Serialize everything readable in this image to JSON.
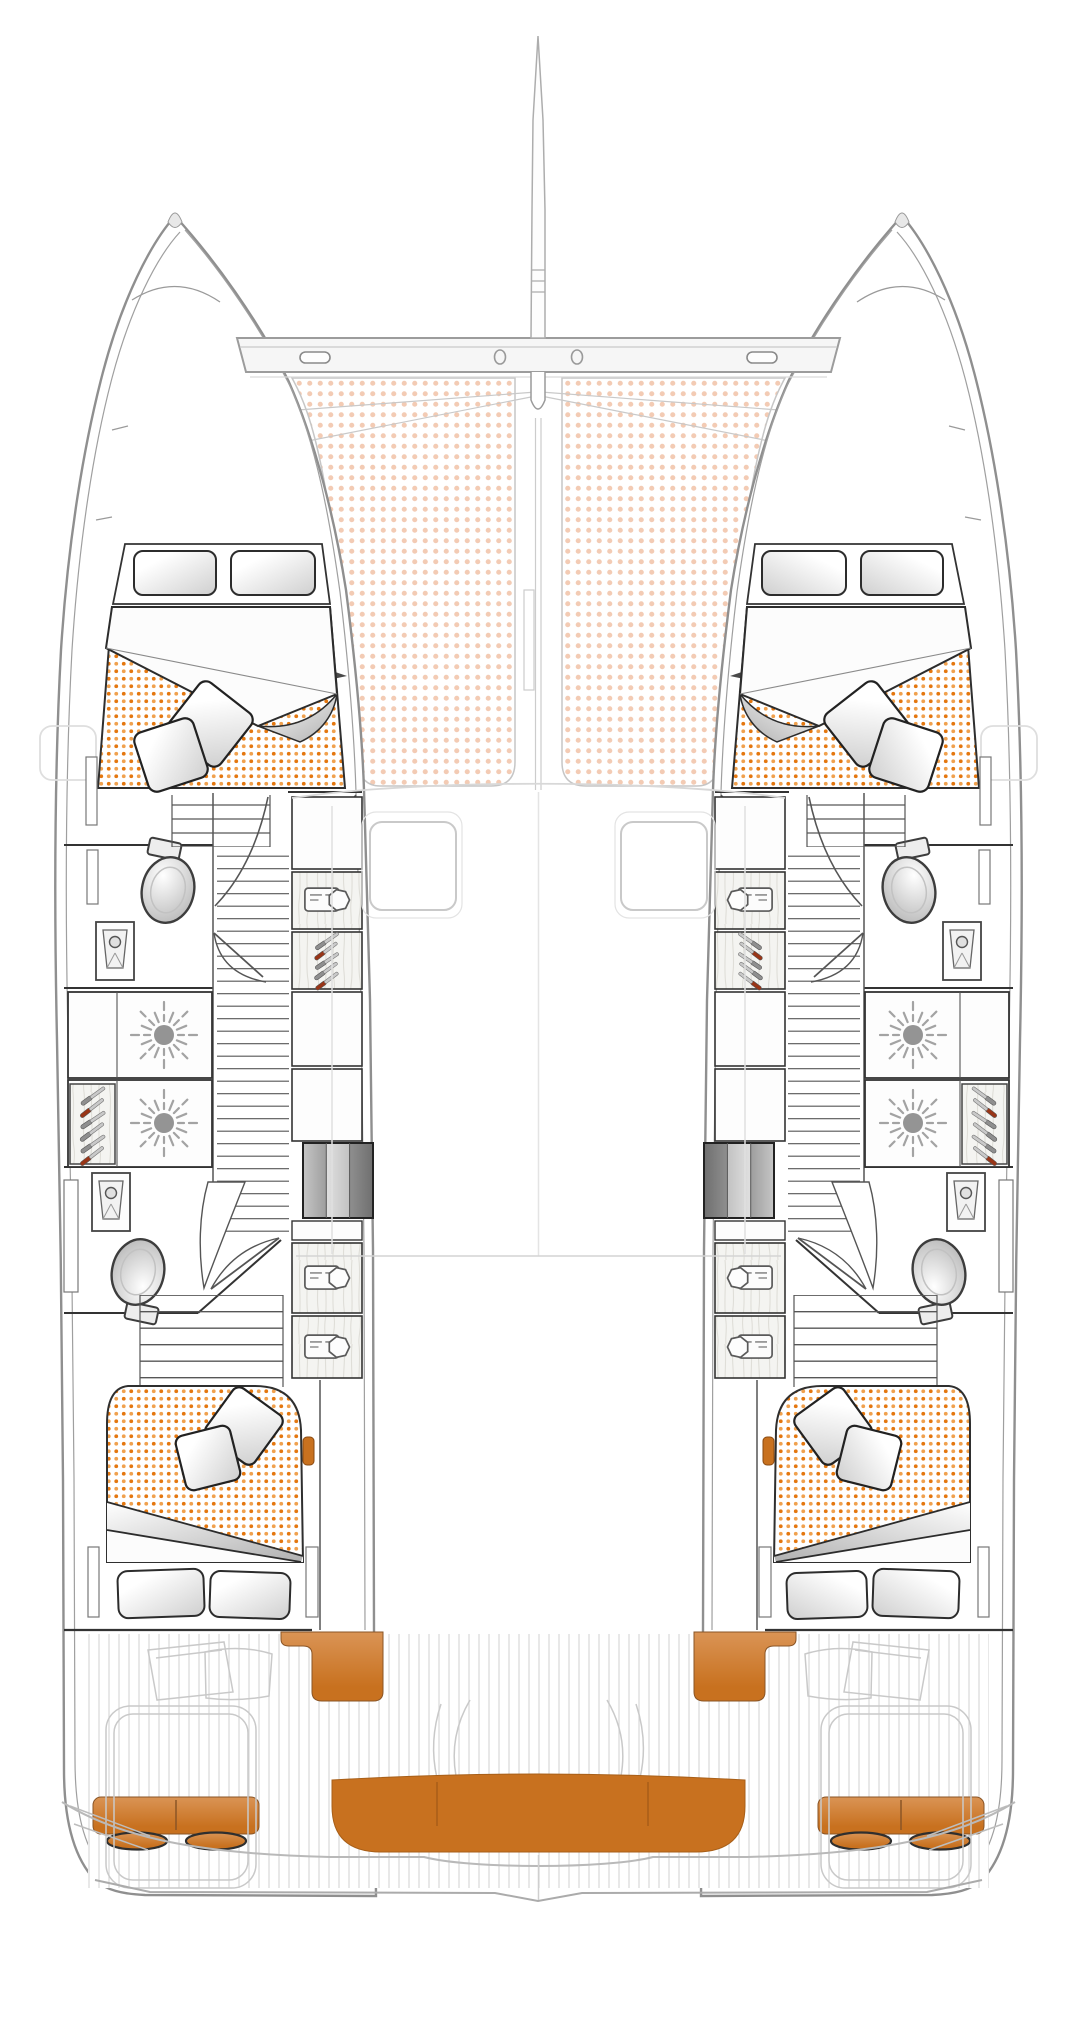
{
  "page": {
    "title": "Catamaran deck and accommodation floor plan",
    "visible_text": []
  },
  "diagram": {
    "type": "boat-floor-plan",
    "vessel": "sailing-catamaran",
    "view": "top-down",
    "orientation": "bow-up",
    "symmetry": "port-starboard mirrored"
  },
  "colors": {
    "paper": "#FFFFFF",
    "accent_orange": "#C8711F",
    "accent_orange_light": "#DA9455",
    "mattress_dot_a": "#E4770F",
    "mattress_dot_b": "#F0A14E",
    "trampoline_dot": "#F3CBB4",
    "wood_base": "#F4F4F1",
    "wood_streak": "#DFDED8",
    "deck_plank": "#D8D8D8",
    "cutlery_red": "#993517",
    "cushion_edge": "#8A5526",
    "outline_dark": "#2F2F2F",
    "outline_mid": "#8F8F8F",
    "outline_faint": "#C9C9C9"
  },
  "areas": {
    "foredeck": [
      "bowsprit",
      "anchor-crossbeam",
      "beam-cleats x2",
      "beam-rings x2",
      "trampoline-net 2 panels",
      "bridle-lines"
    ],
    "port_hull": {
      "forward_cabin": [
        "double-bed",
        "2 head pillows",
        "dotted mattress",
        "folded duvet",
        "2 throw pillows"
      ],
      "forward_bathroom": [
        "toilet",
        "washbasin",
        "door-swing"
      ],
      "galley_lockers": [
        "burner-vent sunburst x2",
        "cutlery-drawer"
      ],
      "companionway": [
        "ladder-steps",
        "landing-curve",
        "door-swing"
      ],
      "aft_bathroom": [
        "washbasin",
        "toilet",
        "door-swing"
      ],
      "inboard_lockers": [
        "hanging-locker x3",
        "cutlery-drawer",
        "entry-steps",
        "orange-grab-handle"
      ],
      "aft_cabin": [
        "double-bed",
        "dotted mattress",
        "folded duvet",
        "2 throw pillows",
        "2 head pillows",
        "step-slats"
      ]
    },
    "starboard_hull": "mirror of port hull",
    "cockpit_and_stern": [
      "teak-plank deck",
      "orange corner seat x2",
      "orange helm bench with 2 oval cushions x2",
      "orange stern sunbed bench",
      "swim-platform outlines",
      "faint cockpit console outlines"
    ]
  },
  "icon_legend": [
    "sunburst-vent-icon",
    "hanging-locker-shirt-icon",
    "cutlery-icon",
    "toilet-icon",
    "washbasin-icon",
    "door-swing-arc",
    "ladder-rungs",
    "gradient-step-box",
    "pillow",
    "throw-pillow",
    "cleat-icon"
  ],
  "counts": {
    "cabins": 4,
    "bathrooms": 4,
    "toilets": 4,
    "basins": 4,
    "hanging_lockers": 6,
    "cutlery_drawers": 4,
    "sunburst_vents": 4
  }
}
